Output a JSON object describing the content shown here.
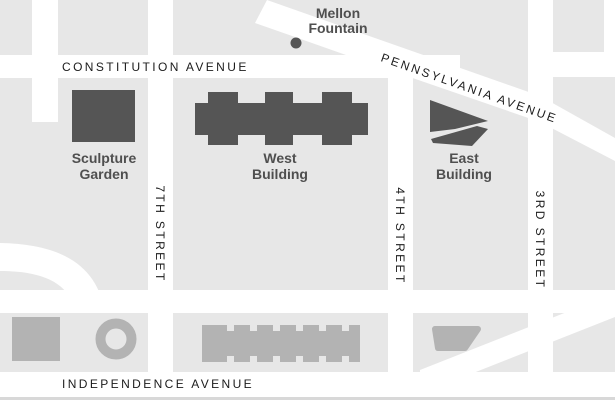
{
  "map": {
    "streets": {
      "constitution": "CONSTITUTION AVENUE",
      "pennsylvania": "PENNSYLVANIA AVENUE",
      "independence": "INDEPENDENCE AVENUE",
      "seventh": "7TH STREET",
      "fourth": "4TH STREET",
      "third": "3RD STREET"
    },
    "places": {
      "mellon_fountain": {
        "line1": "Mellon",
        "line2": "Fountain"
      },
      "sculpture_garden": {
        "line1": "Sculpture",
        "line2": "Garden"
      },
      "west_building": {
        "line1": "West",
        "line2": "Building"
      },
      "east_building": {
        "line1": "East",
        "line2": "Building"
      }
    },
    "colors": {
      "background": "#e7e7e7",
      "street": "#ffffff",
      "building_dark": "#555555",
      "building_light": "#b3b3b3",
      "street_label": "#1b1b1b",
      "place_label": "#4f4f4f"
    }
  }
}
